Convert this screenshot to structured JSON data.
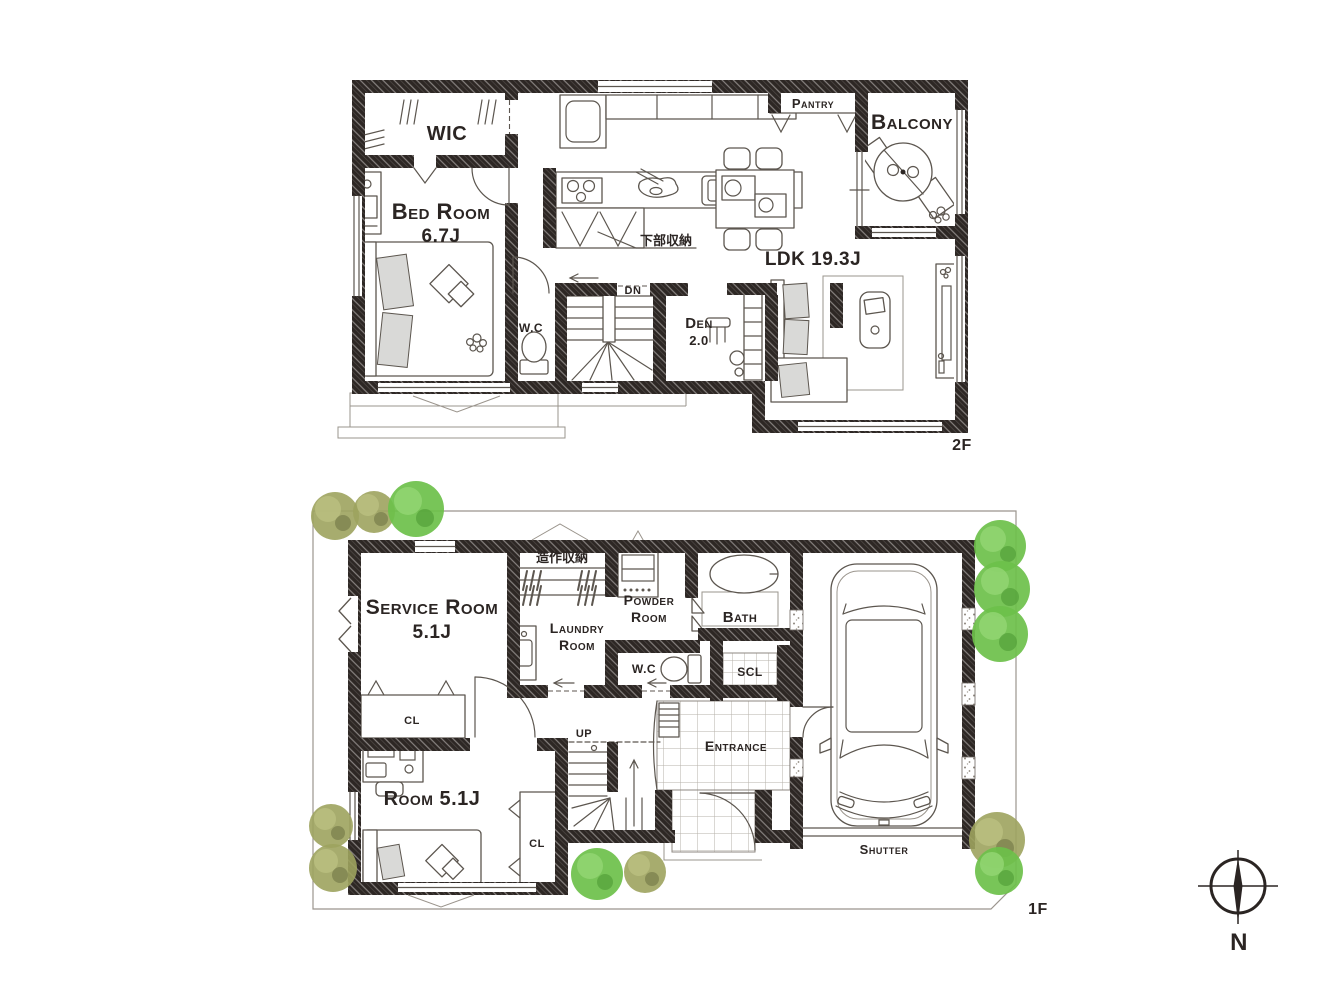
{
  "floor2": {
    "floor_label": "2F",
    "rooms": {
      "wic": "WIC",
      "bedroom_name": "Bed Room",
      "bedroom_size": "6.7J",
      "pantry": "Pantry",
      "balcony": "Balcony",
      "ldk": "LDK 19.3J",
      "wc": "W.C",
      "den_name": "Den",
      "den_size": "2.0"
    },
    "notes": {
      "stairs_down": "DN",
      "lower_storage": "下部収納"
    }
  },
  "floor1": {
    "floor_label": "1F",
    "rooms": {
      "service_name": "Service Room",
      "service_size": "5.1J",
      "laundry_line1": "Laundry",
      "laundry_line2": "Room",
      "powder_line1": "Powder",
      "powder_line2": "Room",
      "bath": "Bath",
      "wc": "W.C",
      "scl": "SCL",
      "entrance": "Entrance",
      "room_name": "Room 5.1J",
      "closet": "CL"
    },
    "notes": {
      "stairs_up": "UP",
      "builtin_storage": "造作収納",
      "shutter": "Shutter"
    }
  },
  "compass": {
    "north": "N"
  }
}
